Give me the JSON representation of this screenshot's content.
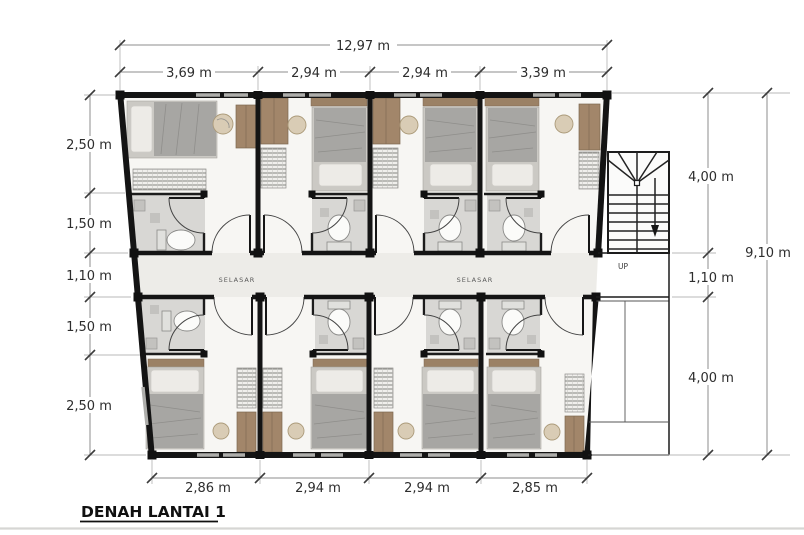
{
  "page": {
    "title": "DENAH LANTAI 1"
  },
  "plan": {
    "corridor_labels": [
      "SELASAR",
      "SELASAR"
    ],
    "stairs_label": "UP",
    "rooms_per_row": 4,
    "features": [
      "bed",
      "wardrobe",
      "rack",
      "bathroom-with-toilet",
      "corridor",
      "staircase"
    ]
  },
  "dimensions": {
    "top_total": "12,97 m",
    "top_segments": [
      "3,69 m",
      "2,94 m",
      "2,94 m",
      "3,39 m"
    ],
    "left_segments": [
      "2,50 m",
      "1,50 m",
      "1,10 m",
      "1,50 m",
      "2,50 m"
    ],
    "right_segments": [
      "4,00 m",
      "1,10 m",
      "4,00 m"
    ],
    "right_total": "9,10 m",
    "bottom_segments": [
      "2,86 m",
      "2,94 m",
      "2,94 m",
      "2,85 m"
    ]
  },
  "colors": {
    "wall": "#141414",
    "wood": "#a2866a",
    "bath_floor": "#d8d7d4",
    "corridor_floor": "#edece8",
    "room_floor": "#f7f6f3",
    "bed_blanket": "#a7a6a3",
    "dim_text": "#2d2d2d",
    "page_rule": "#d6d6d4"
  }
}
